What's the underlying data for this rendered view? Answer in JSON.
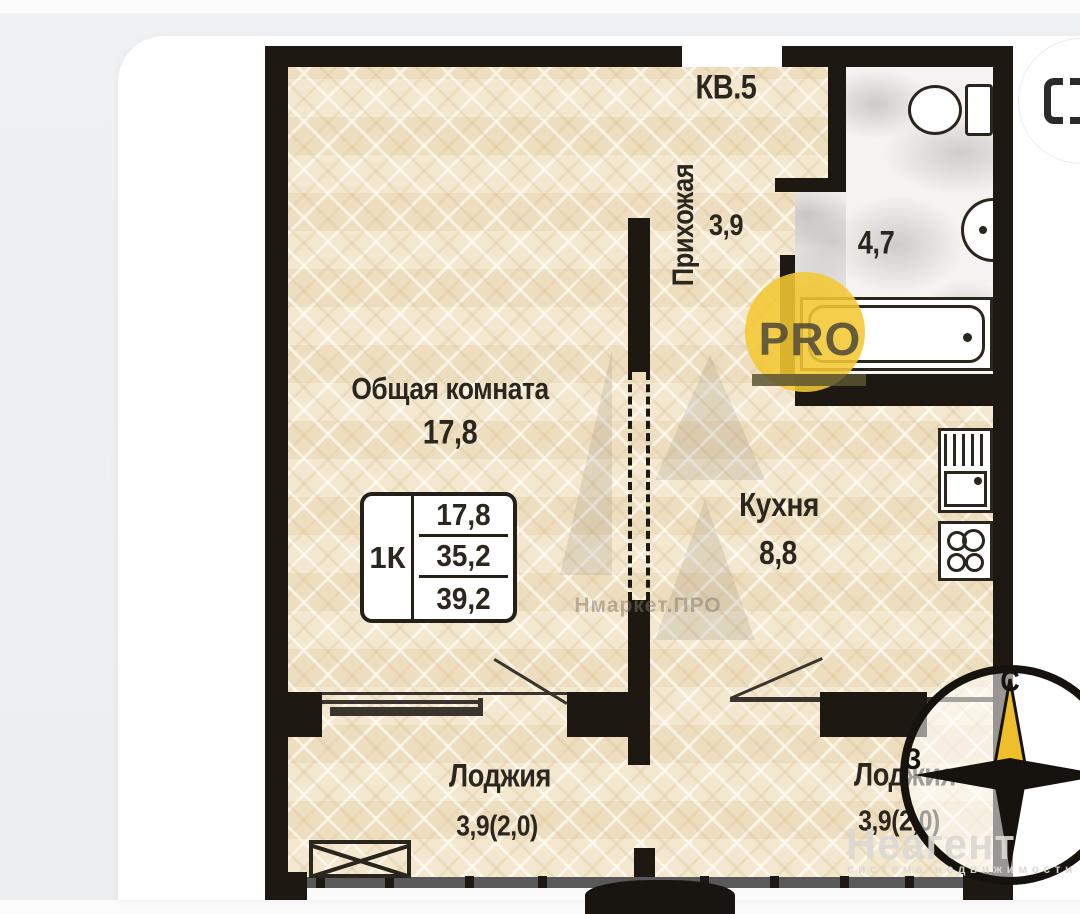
{
  "plan": {
    "apartment_label": "КВ.5",
    "rooms": {
      "living": {
        "name": "Общая комната",
        "area": "17,8"
      },
      "hallway": {
        "name": "Прихожая",
        "area": "3,9"
      },
      "bathroom": {
        "area": "4,7"
      },
      "kitchen": {
        "name": "Кухня",
        "area": "8,8"
      },
      "loggia_left": {
        "name": "Лоджия",
        "area": "3,9(2,0)"
      },
      "loggia_right": {
        "name": "Лоджия",
        "area": "3,9(2,0)"
      }
    },
    "info_table": {
      "type": "1К",
      "living_area": "17,8",
      "area": "35,2",
      "total_area": "39,2"
    },
    "compass": {
      "north": "С",
      "west": "З"
    }
  },
  "watermarks": {
    "pro_badge": "PRO",
    "portal": "Нмаркет.ПРО",
    "agency": "Неагент",
    "agency_subtitle": "система недвижимости"
  },
  "colors": {
    "wall": "#1d1811",
    "parquet": "#f0e2c6",
    "marble": "#f4f3f1",
    "accent_yellow": "#efbf2b"
  }
}
